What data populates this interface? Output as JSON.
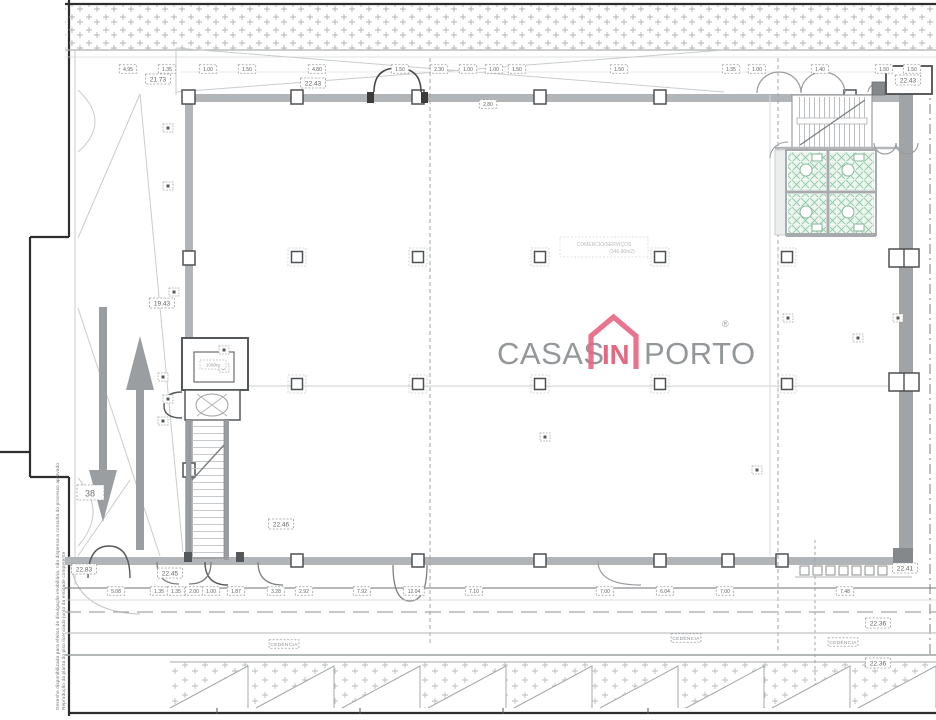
{
  "brand": {
    "casas": "CASAS",
    "in": "IN",
    "porto": "PORTO",
    "registered": "®",
    "gray": "#8f9294",
    "pink": "#e4607d"
  },
  "plan": {
    "room_label": {
      "line1": "COMÉRCIO/SERVIÇOS",
      "line2": "(346.60m2)"
    },
    "lift_label": "1000kg",
    "house_number": "38",
    "cedencia_text": "CEDÊNCIA",
    "side_note_line1": "Desenho disponibilizado para efeitos de divulgação imobiliária, não dispensa a consulta do processo aprovado",
    "side_note_line2": "Reprodução da planta do piso licenciado junto da entidade competente"
  },
  "levels": [
    {
      "x": 158,
      "y": 79,
      "value": "21.73"
    },
    {
      "x": 313,
      "y": 83,
      "value": "22.43"
    },
    {
      "x": 908,
      "y": 80,
      "value": "22.43"
    },
    {
      "x": 162,
      "y": 303,
      "value": "19.43"
    },
    {
      "x": 281,
      "y": 524,
      "value": "22.46"
    },
    {
      "x": 84,
      "y": 569,
      "value": "22.83"
    },
    {
      "x": 170,
      "y": 573,
      "value": "22.45"
    },
    {
      "x": 905,
      "y": 568,
      "value": "22.41"
    },
    {
      "x": 878,
      "y": 623,
      "value": "22.36"
    },
    {
      "x": 878,
      "y": 663,
      "value": "22.36"
    }
  ],
  "dimensions": {
    "top": [
      {
        "x": 128,
        "value": "4.95"
      },
      {
        "x": 167,
        "value": "1.35"
      },
      {
        "x": 208,
        "value": "1.00"
      },
      {
        "x": 247,
        "value": "1.50"
      },
      {
        "x": 317,
        "value": "4.80"
      },
      {
        "x": 400,
        "value": "1.50"
      },
      {
        "x": 439,
        "value": "2.30"
      },
      {
        "x": 468,
        "value": "1.00"
      },
      {
        "x": 494,
        "value": "1.00"
      },
      {
        "x": 517,
        "value": "1.50"
      },
      {
        "x": 619,
        "value": "1.50"
      },
      {
        "x": 731,
        "value": "1.35"
      },
      {
        "x": 757,
        "value": "1.00"
      },
      {
        "x": 820,
        "value": "1.40"
      },
      {
        "x": 884,
        "value": "1.50"
      },
      {
        "x": 912,
        "value": "1.50"
      }
    ],
    "under_wall": [
      {
        "x": 488,
        "y": 104,
        "value": "2.80"
      }
    ],
    "bottom": [
      {
        "x": 116,
        "value": "5.08"
      },
      {
        "x": 159,
        "value": "1.35"
      },
      {
        "x": 176,
        "value": "1.35"
      },
      {
        "x": 194,
        "value": "2.00"
      },
      {
        "x": 211,
        "value": "1.00"
      },
      {
        "x": 236,
        "value": "1.87"
      },
      {
        "x": 276,
        "value": "3.28"
      },
      {
        "x": 304,
        "value": "2.92"
      },
      {
        "x": 362,
        "value": "7.92"
      },
      {
        "x": 414,
        "value": "12.04"
      },
      {
        "x": 474,
        "value": "7.10"
      },
      {
        "x": 605,
        "value": "7.00"
      },
      {
        "x": 665,
        "value": "6.04"
      },
      {
        "x": 725,
        "value": "7.00"
      },
      {
        "x": 845,
        "value": "7.48"
      }
    ]
  },
  "cedencia_positions": [
    {
      "x": 284,
      "y": 644
    },
    {
      "x": 686,
      "y": 638
    },
    {
      "x": 843,
      "y": 642
    }
  ],
  "markers": [
    {
      "x": 168,
      "y": 128
    },
    {
      "x": 168,
      "y": 186
    },
    {
      "x": 174,
      "y": 292
    },
    {
      "x": 163,
      "y": 377
    },
    {
      "x": 168,
      "y": 399
    },
    {
      "x": 163,
      "y": 421
    },
    {
      "x": 224,
      "y": 350
    },
    {
      "x": 224,
      "y": 368
    },
    {
      "x": 788,
      "y": 318
    },
    {
      "x": 858,
      "y": 338
    },
    {
      "x": 898,
      "y": 318
    },
    {
      "x": 757,
      "y": 470
    },
    {
      "x": 545,
      "y": 437
    }
  ],
  "columns": {
    "rows": [
      257,
      384
    ],
    "xs": [
      297,
      418,
      540,
      660,
      787
    ]
  }
}
